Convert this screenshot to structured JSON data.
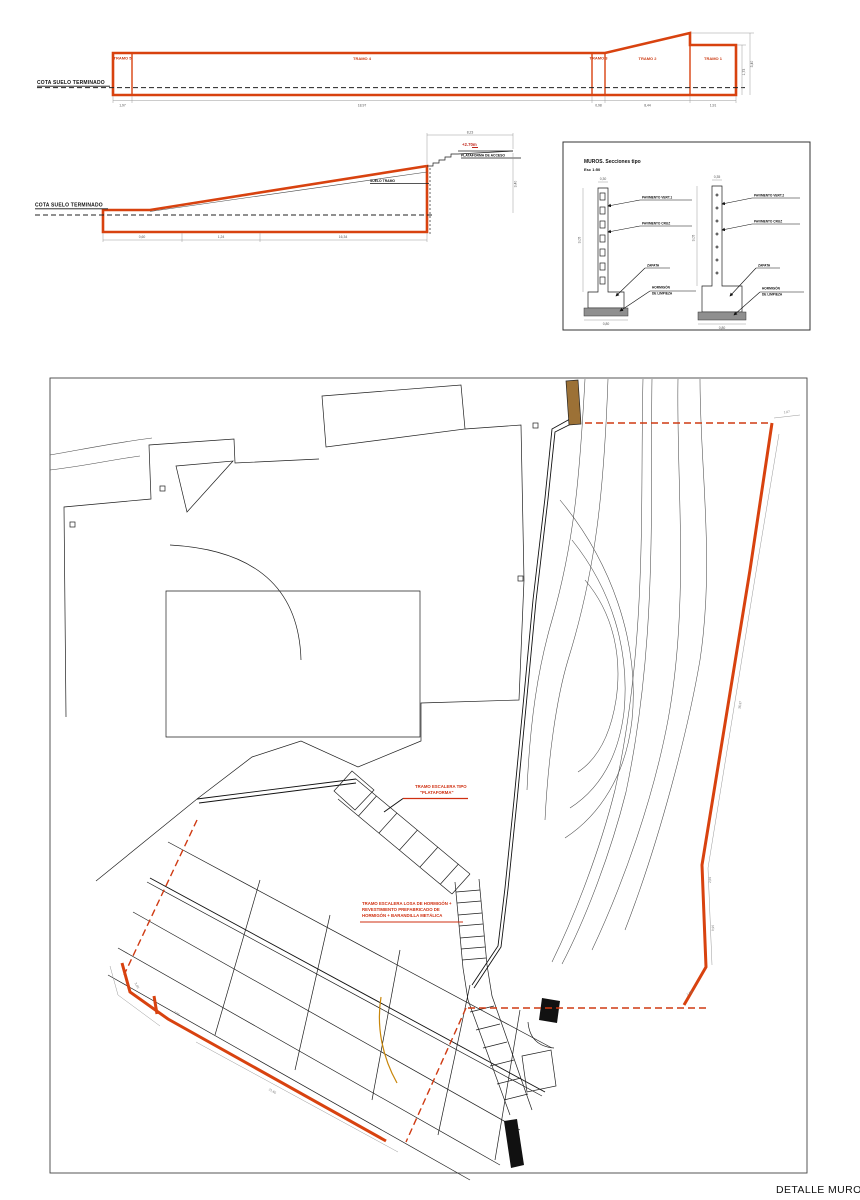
{
  "colors": {
    "wall_red": "#d8420f",
    "dashed_red": "#cf3a12",
    "note_red": "#cf2f10",
    "line_black": "#1f1f1f",
    "dim_gray": "#999999",
    "earth_brown": "#9c7136",
    "ochre_curve": "#c8860a"
  },
  "elevation_long": {
    "cota_label": "COTA SUELO TERMINADO",
    "tramos": [
      "TRAMO 5",
      "TRAMO 4",
      "TRAMO 3",
      "TRAMO 2",
      "TRAMO 1"
    ],
    "dims_bottom": [
      "1,97",
      "18,97",
      "0,98",
      "8,44",
      "1,91"
    ],
    "dim_right_inner": "1,73",
    "dim_right_outer": "3,40"
  },
  "elevation_ramp": {
    "cota_label": "COTA SUELO TERMINADO",
    "level_label": "+2.70m",
    "platform_label": "PLATAFORMA DE ACCESO",
    "slope_label": "SUELO TRAMO",
    "dim_top": "8,23",
    "dim_right": "3,40",
    "dims_bottom": [
      "0,60",
      "1,24",
      "16,34"
    ]
  },
  "sections": {
    "title": "MUROS. Secciones tipo",
    "scale": "Esc 1:50",
    "left": {
      "dim_top": "0,30",
      "dim_height": "3,05",
      "dim_bottom": "0,80",
      "callout_1": "PAVIMENTO VERT.1",
      "callout_2": "PAVIMENTO CRUZ",
      "callout_3": "ZAPATA",
      "callout_4a": "HORMIGÓN",
      "callout_4b": "DE LIMPIEZA"
    },
    "right": {
      "dim_top": "0,35",
      "dim_height": "3,05",
      "dim_bottom": "0,80",
      "callout_1": "PAVIMENTO VERT.2",
      "callout_2": "PAVIMENTO CRUZ",
      "callout_3": "ZAPATA",
      "callout_4a": "HORMIGÓN",
      "callout_4b": "DE LIMPIEZA"
    }
  },
  "plan": {
    "note_platform_line1": "TRAMO ESCALERA TIPO",
    "note_platform_line2": "\"PLATAFORMA\"",
    "note_stair_line1": "TRAMO ESCALERA LOSA DE HORMIGÓN +",
    "note_stair_line2": "REVESTIMIENTO PREFABRICADO DE",
    "note_stair_line3": "HORMIGÓN + BARANDILLA METÁLICA",
    "dim_top_right": "1,07",
    "dim_wall_upper": "36,97",
    "dim_wall_mid": "2,69",
    "dim_wall_lower": "9,95",
    "dim_wall_end": "1,03",
    "dim_left_1": "3,05",
    "dim_left_2": "2,09",
    "dim_left_3": "21,65"
  },
  "footer": {
    "title": "DETALLE MUROS"
  }
}
